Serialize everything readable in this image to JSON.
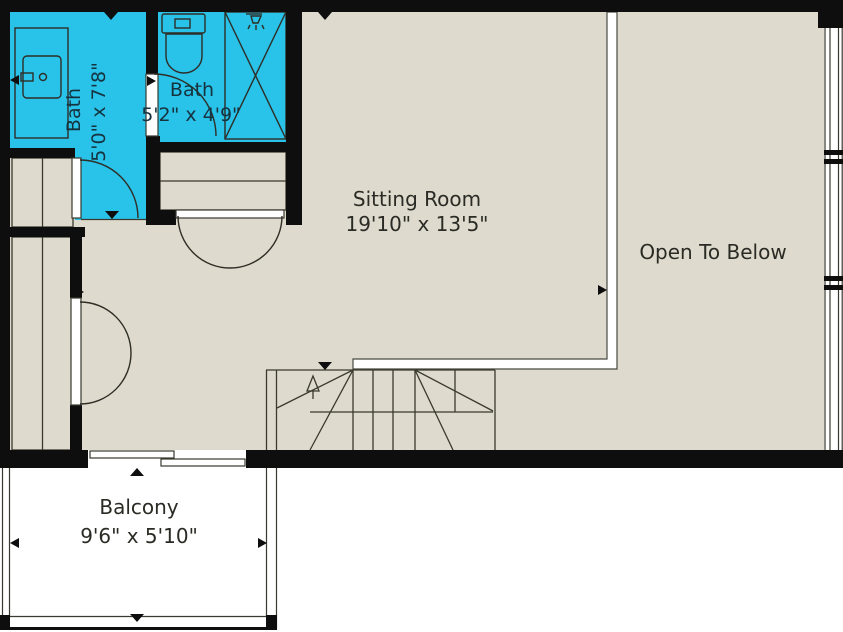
{
  "plan": {
    "title": "Upper floor plan",
    "rooms": {
      "bath1": {
        "label": "Bath",
        "dimensions": "5'0\" x 7'8\""
      },
      "bath2": {
        "label": "Bath",
        "dimensions": "5'2\" x 4'9\""
      },
      "sitting_room": {
        "label": "Sitting Room",
        "dimensions": "19'10\" x 13'5\""
      },
      "open_to_below": {
        "label": "Open To Below"
      },
      "balcony": {
        "label": "Balcony",
        "dimensions": "9'6\" x 5'10\""
      }
    },
    "colors": {
      "bathroom_fill": "#29c2e8",
      "floor_fill": "#dedacd",
      "wall": "#0e0e0e",
      "balcony_fill": "#ffffff",
      "room_label_text": "#2b2b25",
      "bath_label_text": "#16323f"
    },
    "fixtures": [
      "vanity-sink",
      "toilet",
      "shower",
      "staircase",
      "double-door",
      "swing-door",
      "sliding-door",
      "window",
      "railing",
      "closet"
    ]
  }
}
